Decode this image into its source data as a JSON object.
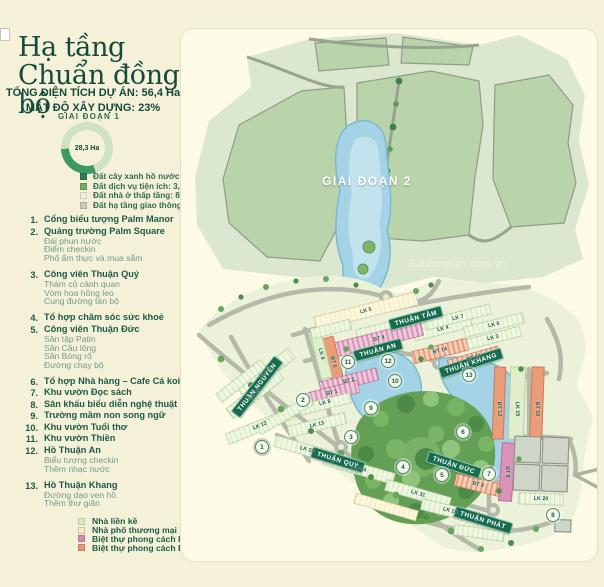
{
  "sidebar": {
    "title_line1": "Hạ tầng",
    "title_line2": "Chuẩn đồng bộ",
    "stat_line1": "TỔNG DIỆN TÍCH DỰ ÁN: 56,4 Ha",
    "stat_line2": "MẬT ĐỘ XÂY DỰNG: 23%",
    "phase1_label": "GIAI ĐOẠN 1",
    "donut": {
      "value_label": "28,3 Ha",
      "fraction": 0.3,
      "arc_color": "#3d9a5f",
      "ring_color": "#cfe2c4"
    },
    "land_legend": [
      {
        "label": "Đất cây xanh hồ nước: 3,6 Ha",
        "color": "#2e7d4f"
      },
      {
        "label": "Đất dịch vụ tiện ích: 3,8 Ha",
        "color": "#6fae5e"
      },
      {
        "label": "Đất nhà ở thấp tầng: 8,3 Ha (676 lô)",
        "color": "#f0efe4"
      },
      {
        "label": "Đất hạ tầng giao thông 12,6 Ha",
        "color": "#c5cdb9"
      }
    ],
    "amenities": [
      {
        "num": "1.",
        "title": "Cổng biểu tượng Palm Manor",
        "subs": []
      },
      {
        "num": "2.",
        "title": "Quảng trường Palm Square",
        "subs": [
          "Đài phun nước",
          "Điểm checkin",
          "Phố ẩm thực và mua sắm"
        ]
      },
      {
        "num": "3.",
        "title": "Công viên Thuận Quý",
        "subs": [
          "Thảm cỏ cảnh quan",
          "Vòm hoa hồng leo",
          "Cung đường tản bộ"
        ]
      },
      {
        "num": "4.",
        "title": "Tổ hợp chăm sóc sức khoẻ",
        "subs": []
      },
      {
        "num": "5.",
        "title": "Công viên Thuận Đức",
        "subs": [
          "Sân tập Patin",
          "Sân Cầu lông",
          "Sân Bóng rổ",
          "Đường chạy bộ"
        ]
      },
      {
        "num": "6.",
        "title": "Tổ hợp Nhà hàng – Cafe Cá koi",
        "subs": []
      },
      {
        "num": "7.",
        "title": "Khu vườn Đọc sách",
        "subs": []
      },
      {
        "num": "8.",
        "title": "Sân khấu biểu diễn nghệ thuật",
        "subs": []
      },
      {
        "num": "9.",
        "title": "Trường mầm non song ngữ",
        "subs": []
      },
      {
        "num": "10.",
        "title": "Khu vườn Tuổi thơ",
        "subs": []
      },
      {
        "num": "11.",
        "title": "Khu vườn Thiền",
        "subs": []
      },
      {
        "num": "12.",
        "title": "Hồ Thuận An",
        "subs": [
          "Biểu tượng checkin",
          "Thềm nhạc nước"
        ]
      },
      {
        "num": "13.",
        "title": "Hồ Thuận Khang",
        "subs": [
          "Đường dạo ven hồ",
          "Thềm thư giãn"
        ]
      }
    ],
    "housing_legend": [
      {
        "label": "Nhà liền kề",
        "color": "#dde8cb"
      },
      {
        "label": "Nhà phố thương mại",
        "color": "#f6edc4"
      },
      {
        "label": "Biệt thự phong cách hiện đại",
        "color": "#d68cb2"
      },
      {
        "label": "Biệt thự phong cách Bắc Mỹ",
        "color": "#e59776"
      }
    ]
  },
  "map": {
    "phase2_label": "GIAI ĐOẠN 2",
    "watermark": "Batdongsan.com.vn",
    "streets": [
      {
        "label": "THUẬN TÂM",
        "x": 235,
        "y": 289,
        "rot": -15
      },
      {
        "label": "THUẬN AN",
        "x": 197,
        "y": 321,
        "rot": -15
      },
      {
        "label": "THUẬN KHANG",
        "x": 290,
        "y": 334,
        "rot": -18
      },
      {
        "label": "THUẬN NGUYÊN",
        "x": 76,
        "y": 358,
        "rot": -52
      },
      {
        "label": "THUẬN ĐỨC",
        "x": 273,
        "y": 436,
        "rot": 18
      },
      {
        "label": "THUẬN QUÝ",
        "x": 157,
        "y": 431,
        "rot": 17
      },
      {
        "label": "THUẬN PHÁT",
        "x": 302,
        "y": 491,
        "rot": 17
      }
    ],
    "blocks": [
      {
        "label": "LK 5",
        "x": 185,
        "y": 282,
        "rot": -14
      },
      {
        "label": "LK 4",
        "x": 262,
        "y": 300,
        "rot": -14
      },
      {
        "label": "LK 7",
        "x": 277,
        "y": 289,
        "rot": -14
      },
      {
        "label": "LK 6",
        "x": 313,
        "y": 296,
        "rot": -14
      },
      {
        "label": "LK 3",
        "x": 312,
        "y": 309,
        "rot": -14
      },
      {
        "label": "BT 14",
        "x": 259,
        "y": 322,
        "rot": -14
      },
      {
        "label": "BT 13",
        "x": 293,
        "y": 329,
        "rot": -16
      },
      {
        "label": "BT 4",
        "x": 198,
        "y": 310,
        "rot": -14
      },
      {
        "label": "BT 5",
        "x": 152,
        "y": 333,
        "rot": 76
      },
      {
        "label": "LK 9",
        "x": 140,
        "y": 325,
        "rot": 76
      },
      {
        "label": "BT 2",
        "x": 168,
        "y": 352,
        "rot": -14
      },
      {
        "label": "BT 1",
        "x": 151,
        "y": 364,
        "rot": -14
      },
      {
        "label": "LK 8",
        "x": 144,
        "y": 374,
        "rot": -14
      },
      {
        "label": "LK 10",
        "x": 85,
        "y": 344,
        "rot": -38
      },
      {
        "label": "LK 11",
        "x": 74,
        "y": 365,
        "rot": -38
      },
      {
        "label": "LK 12",
        "x": 79,
        "y": 397,
        "rot": -22
      },
      {
        "label": "LK 13",
        "x": 136,
        "y": 396,
        "rot": -14
      },
      {
        "label": "LK 22",
        "x": 126,
        "y": 421,
        "rot": 16
      },
      {
        "label": "LK 34",
        "x": 178,
        "y": 440,
        "rot": 16
      },
      {
        "label": "LK 31",
        "x": 237,
        "y": 465,
        "rot": 16
      },
      {
        "label": "BT 9",
        "x": 297,
        "y": 456,
        "rot": 14
      },
      {
        "label": "LK 18",
        "x": 269,
        "y": 482,
        "rot": 14
      },
      {
        "label": "LK 20",
        "x": 360,
        "y": 470,
        "rot": 2
      },
      {
        "label": "BT 8",
        "x": 326,
        "y": 443,
        "rot": 86
      },
      {
        "label": "BT 12",
        "x": 318,
        "y": 380,
        "rot": 88
      },
      {
        "label": "LK 15",
        "x": 336,
        "y": 380,
        "rot": 88
      },
      {
        "label": "BT 10",
        "x": 356,
        "y": 380,
        "rot": 88
      }
    ],
    "markers": [
      {
        "n": "1",
        "x": 81,
        "y": 418
      },
      {
        "n": "2",
        "x": 122,
        "y": 371
      },
      {
        "n": "3",
        "x": 170,
        "y": 408
      },
      {
        "n": "4",
        "x": 222,
        "y": 438
      },
      {
        "n": "5",
        "x": 261,
        "y": 446
      },
      {
        "n": "6",
        "x": 282,
        "y": 403
      },
      {
        "n": "7",
        "x": 308,
        "y": 445
      },
      {
        "n": "8",
        "x": 372,
        "y": 486
      },
      {
        "n": "9",
        "x": 190,
        "y": 379
      },
      {
        "n": "10",
        "x": 214,
        "y": 352
      },
      {
        "n": "11",
        "x": 167,
        "y": 333
      },
      {
        "n": "12",
        "x": 207,
        "y": 332
      },
      {
        "n": "13",
        "x": 288,
        "y": 346
      }
    ]
  }
}
